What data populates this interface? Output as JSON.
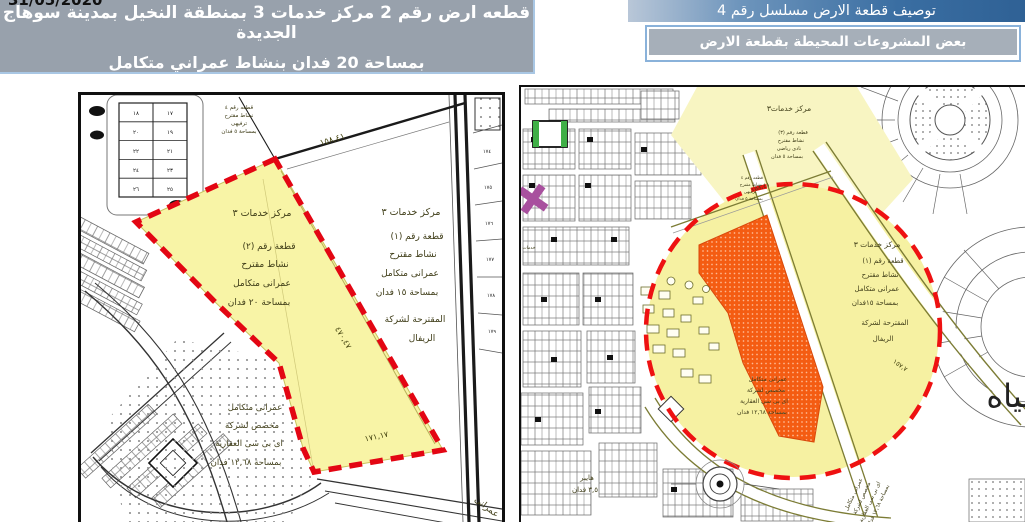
{
  "slide": {
    "date": "31/05/2020",
    "left_header": {
      "line1": "قطعه ارض رقم 2 مركز خدمات 3 بمنطقة النخيل بمدينة سوهاج الجديدة",
      "line2": "بمساحة 20 فدان بنشاط  عمراني متكامل"
    },
    "right_header": {
      "title": "توصيف قطعة الارض  مسلسل رقم 4",
      "subtitle": "بعض المشروعات المحيطة بقطعة الارض"
    }
  },
  "colors": {
    "header_gray": "#98a1ac",
    "title_blue": "#3a6ea2",
    "plot_yellow": "#f8f4a6",
    "plot_orange": "#f45c12",
    "boundary_red": "#e30613"
  },
  "left_map": {
    "plot_title": "مركز خدمات ٣",
    "plot_lines": [
      "قطعة رقم (٢)",
      "نشاط مقترح",
      "عمرانى متكامل",
      "بمساحة ٢٠ فدان"
    ],
    "adjacent_title": "مركز خدمات ٣",
    "adjacent_lines": [
      "قطعة رقم (١)",
      "نشاط مقترح",
      "عمرانى متكامل",
      "بمساحة ١٥ فدان",
      "المقترحة لشركة",
      "الريفال"
    ],
    "company_lines": [
      "عمرانى متكامل",
      "مخصص لشركة",
      "اى بى سى العقارية",
      "بمساحة ١٢,٦٨ فدان"
    ],
    "small_plot_lines": [
      "قطعه رقم ٤",
      "نشاط مقترح",
      "ترفيهى",
      "بمساحة ٥ فدان"
    ],
    "dim_top": "١٥٨,٤١",
    "dim_right": "٤٧٠,٤٧",
    "dim_bottom": "١٧١,١٧",
    "corner_text": "عمرانى",
    "parcel_table": [
      [
        "١٧",
        "١٨"
      ],
      [
        "١٩",
        "٢٠"
      ],
      [
        "٢١",
        "٢٢"
      ],
      [
        "٢٣",
        "٢٤"
      ],
      [
        "٢٥",
        "٢٦"
      ]
    ],
    "road_parcels": [
      "١٧٤",
      "١٧٥",
      "١٧٦",
      "١٧٧",
      "١٧٨",
      "١٧٩"
    ]
  },
  "right_map": {
    "center_title": "مركز خدمات٣",
    "plot3_lines": [
      "قطعة رقم (٣)",
      "نشاط مقترح",
      "نادى رياضى",
      "بمساحة ٥ فدان"
    ],
    "plot4_lines": [
      "قطعه رقم ٤",
      "نشاط مقترح",
      "ترفيهى",
      "بمساحة ٥ فدان"
    ],
    "plot1_title": "مركز خدمات ٣",
    "plot1_lines": [
      "قطعة رقم (١)",
      "نشاط مقترح",
      "عمرانى متكامل",
      "بمساحة ١٥فدان",
      "المقترحة لشركة",
      "الريفال"
    ],
    "company_lines": [
      "عمرانى متكامل",
      "مخصص لشركة",
      "اى بى سى العقارية",
      "بمساحة ١٢,٦٨ فدان"
    ],
    "company_diagonal": [
      "عمرانى متكامل",
      "مخصص لشركة",
      "اى بى سى العقارية",
      "بمساحة ١٢,٦٨ فدان"
    ],
    "hyper_lines": [
      "هايبر",
      "٣,٥ فدان"
    ],
    "district_text": "خدمات",
    "water_text": "مياه",
    "dim_top": "١٥٨,٤١",
    "dim_right": "١٥٧,٧"
  }
}
